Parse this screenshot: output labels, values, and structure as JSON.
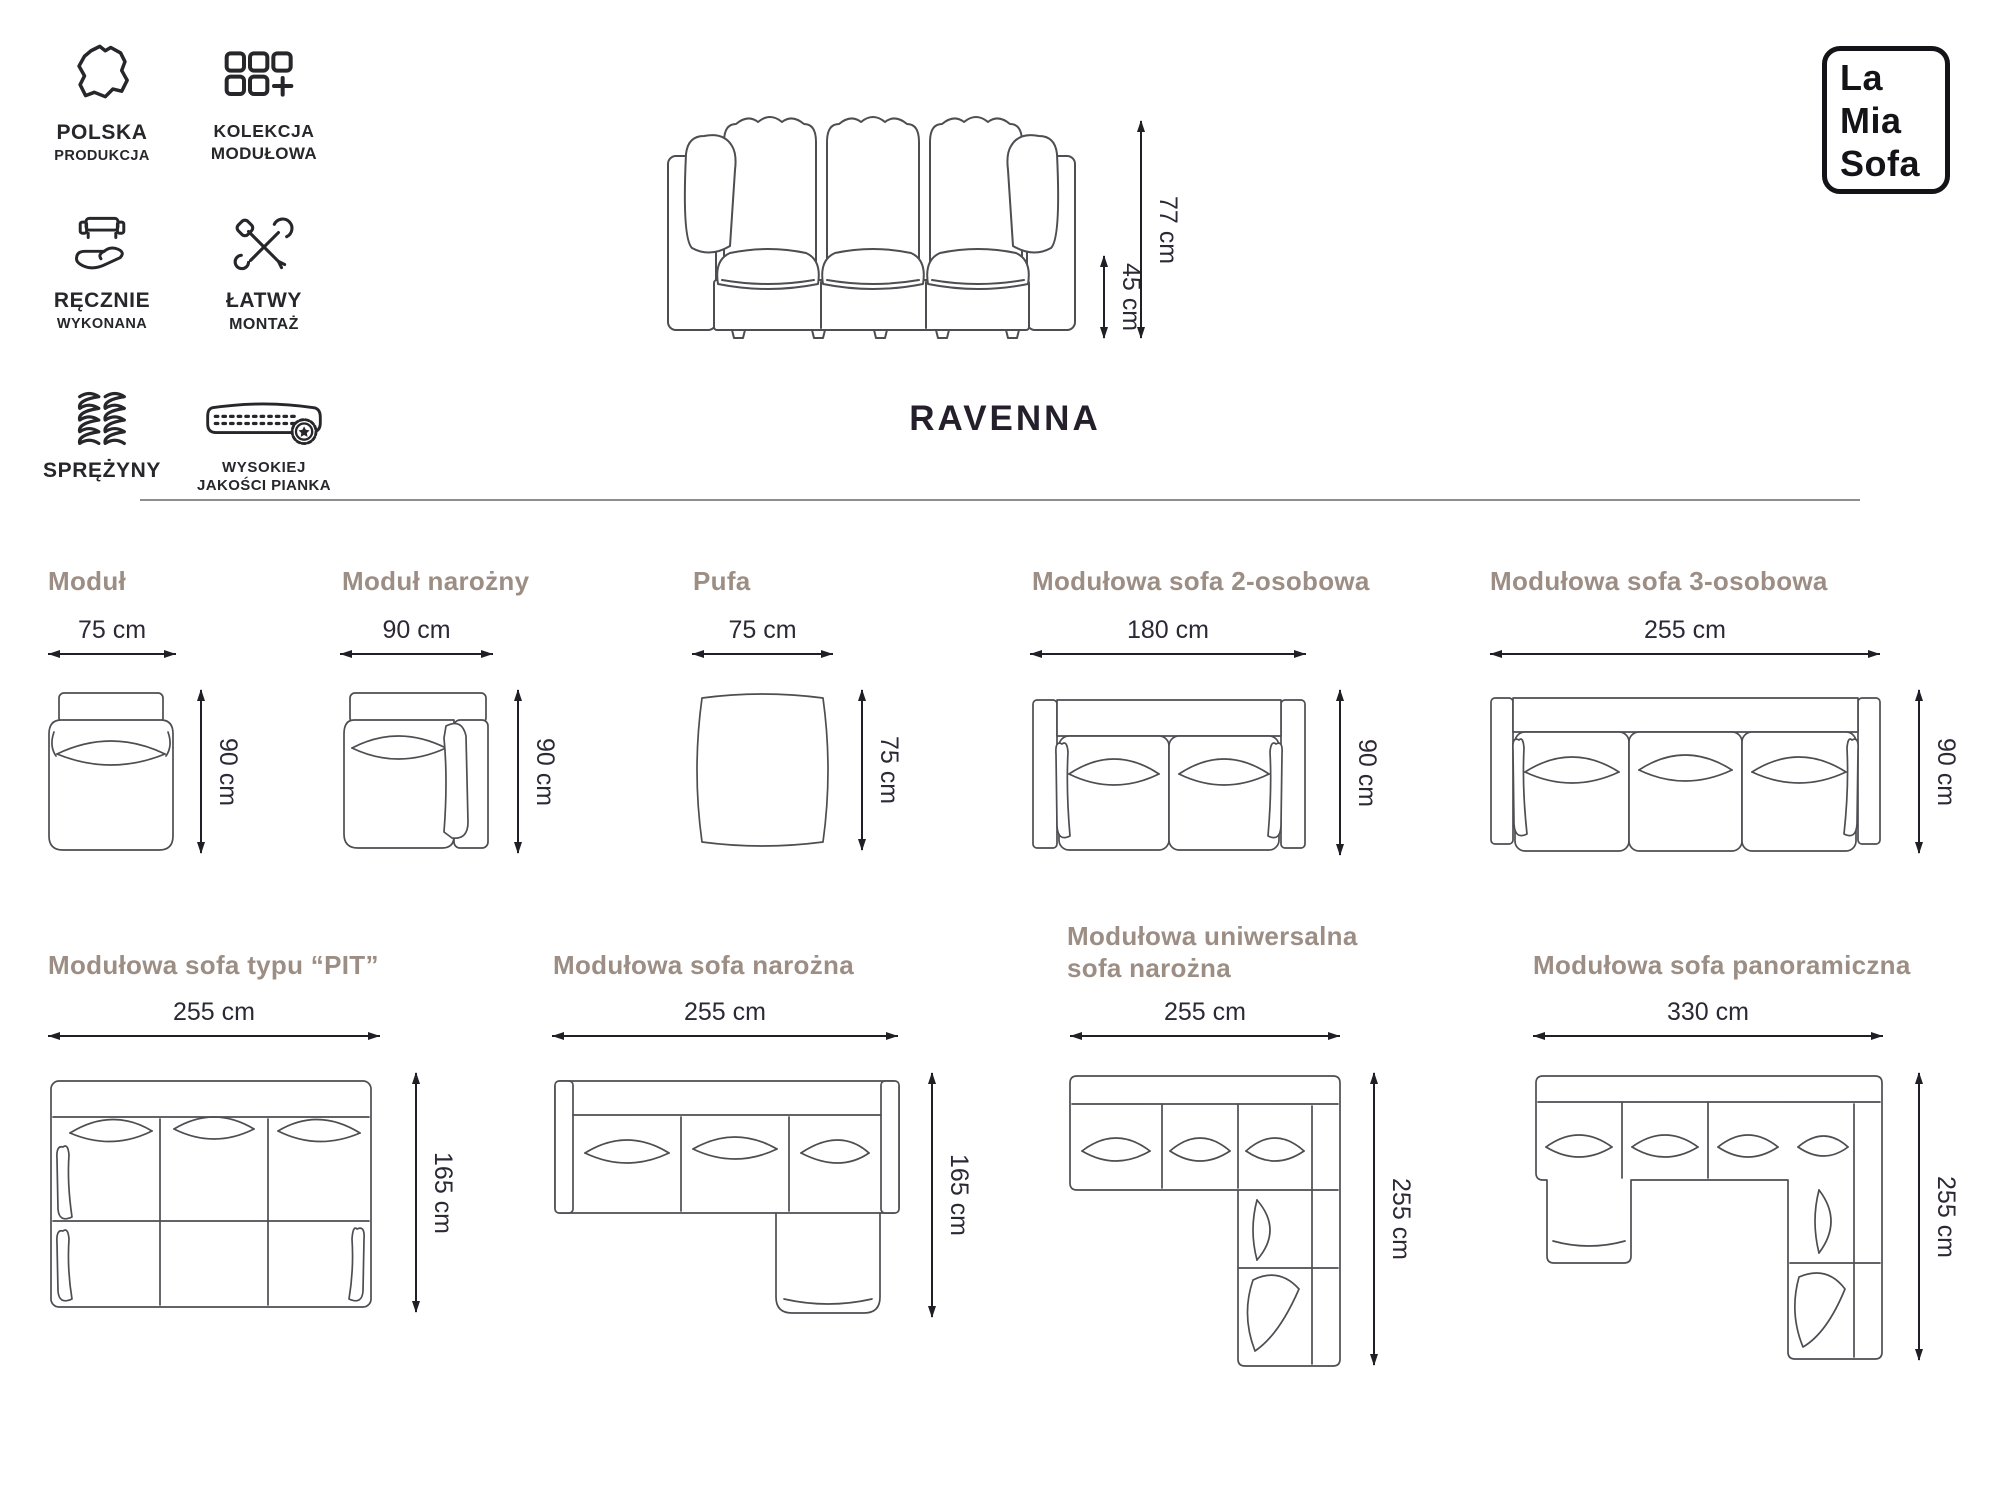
{
  "brand": {
    "logo_lines": [
      "La",
      "Mia",
      "Sofa"
    ]
  },
  "product": {
    "title": "RAVENNA",
    "height_label": "77 cm",
    "seat_height_label": "45 cm"
  },
  "features": [
    {
      "icon": "poland-map-icon",
      "line1": "POLSKA",
      "line2": "PRODUKCJA"
    },
    {
      "icon": "modular-collection-icon",
      "line1": "KOLEKCJA",
      "line2": "MODUŁOWA"
    },
    {
      "icon": "handmade-icon",
      "line1": "RĘCZNIE",
      "line2": "WYKONANA"
    },
    {
      "icon": "easy-assembly-icon",
      "line1": "ŁATWY",
      "line2": "MONTAŻ"
    },
    {
      "icon": "springs-icon",
      "line1": "SPRĘŻYNY",
      "line2": ""
    },
    {
      "icon": "high-quality-foam-icon",
      "line1": "WYSOKIEJ",
      "line2": "JAKOŚCI PIANKA"
    }
  ],
  "modules": [
    {
      "name": "Moduł",
      "width": "75 cm",
      "depth": "90 cm"
    },
    {
      "name": "Moduł narożny",
      "width": "90 cm",
      "depth": "90 cm"
    },
    {
      "name": "Pufa",
      "width": "75 cm",
      "depth": "75 cm"
    },
    {
      "name": "Modułowa sofa 2-osobowa",
      "width": "180 cm",
      "depth": "90 cm"
    },
    {
      "name": "Modułowa sofa 3-osobowa",
      "width": "255 cm",
      "depth": "90 cm"
    },
    {
      "name": "Modułowa sofa typu “PIT”",
      "width": "255 cm",
      "depth": "165 cm"
    },
    {
      "name": "Modułowa sofa narożna",
      "width": "255 cm",
      "depth": "165 cm"
    },
    {
      "name": "Modułowa uniwersalna sofa narożna",
      "width": "255 cm",
      "depth": "255 cm"
    },
    {
      "name": "Modułowa sofa panoramiczna",
      "width": "330 cm",
      "depth": "255 cm"
    }
  ],
  "colors": {
    "ink": "#262330",
    "title_taupe": "#9c8e84",
    "drawing_line": "#4d4d52",
    "arrow": "#1f1f26",
    "divider": "#8e8e8e",
    "logo": "#141418"
  }
}
